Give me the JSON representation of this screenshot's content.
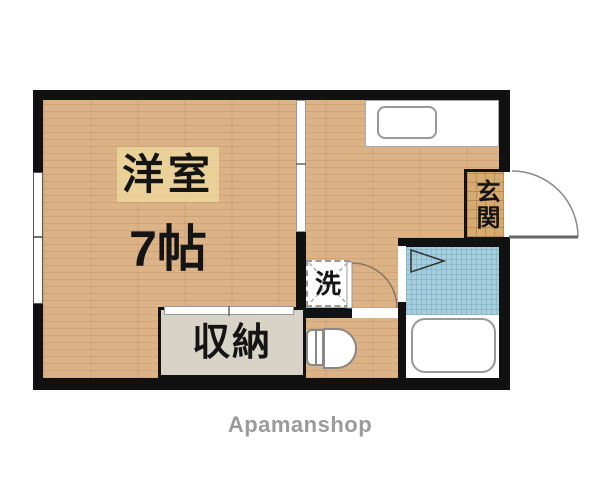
{
  "plan": {
    "watermark": "Apamanshop",
    "rooms": {
      "western_room": {
        "name": "洋室",
        "size": "7帖"
      },
      "closet": {
        "name": "収納"
      },
      "entrance": {
        "name": "玄関"
      },
      "laundry": {
        "name": "洗"
      }
    },
    "colors": {
      "wall": "#111111",
      "wood_floor": "#dcb287",
      "genkan_tile": "#d6ab72",
      "bath_tile": "#a6cfdd",
      "closet_fill": "#d7d3c7",
      "label_highlight": "#eeda9e",
      "watermark_text": "#9b9b9b"
    }
  }
}
